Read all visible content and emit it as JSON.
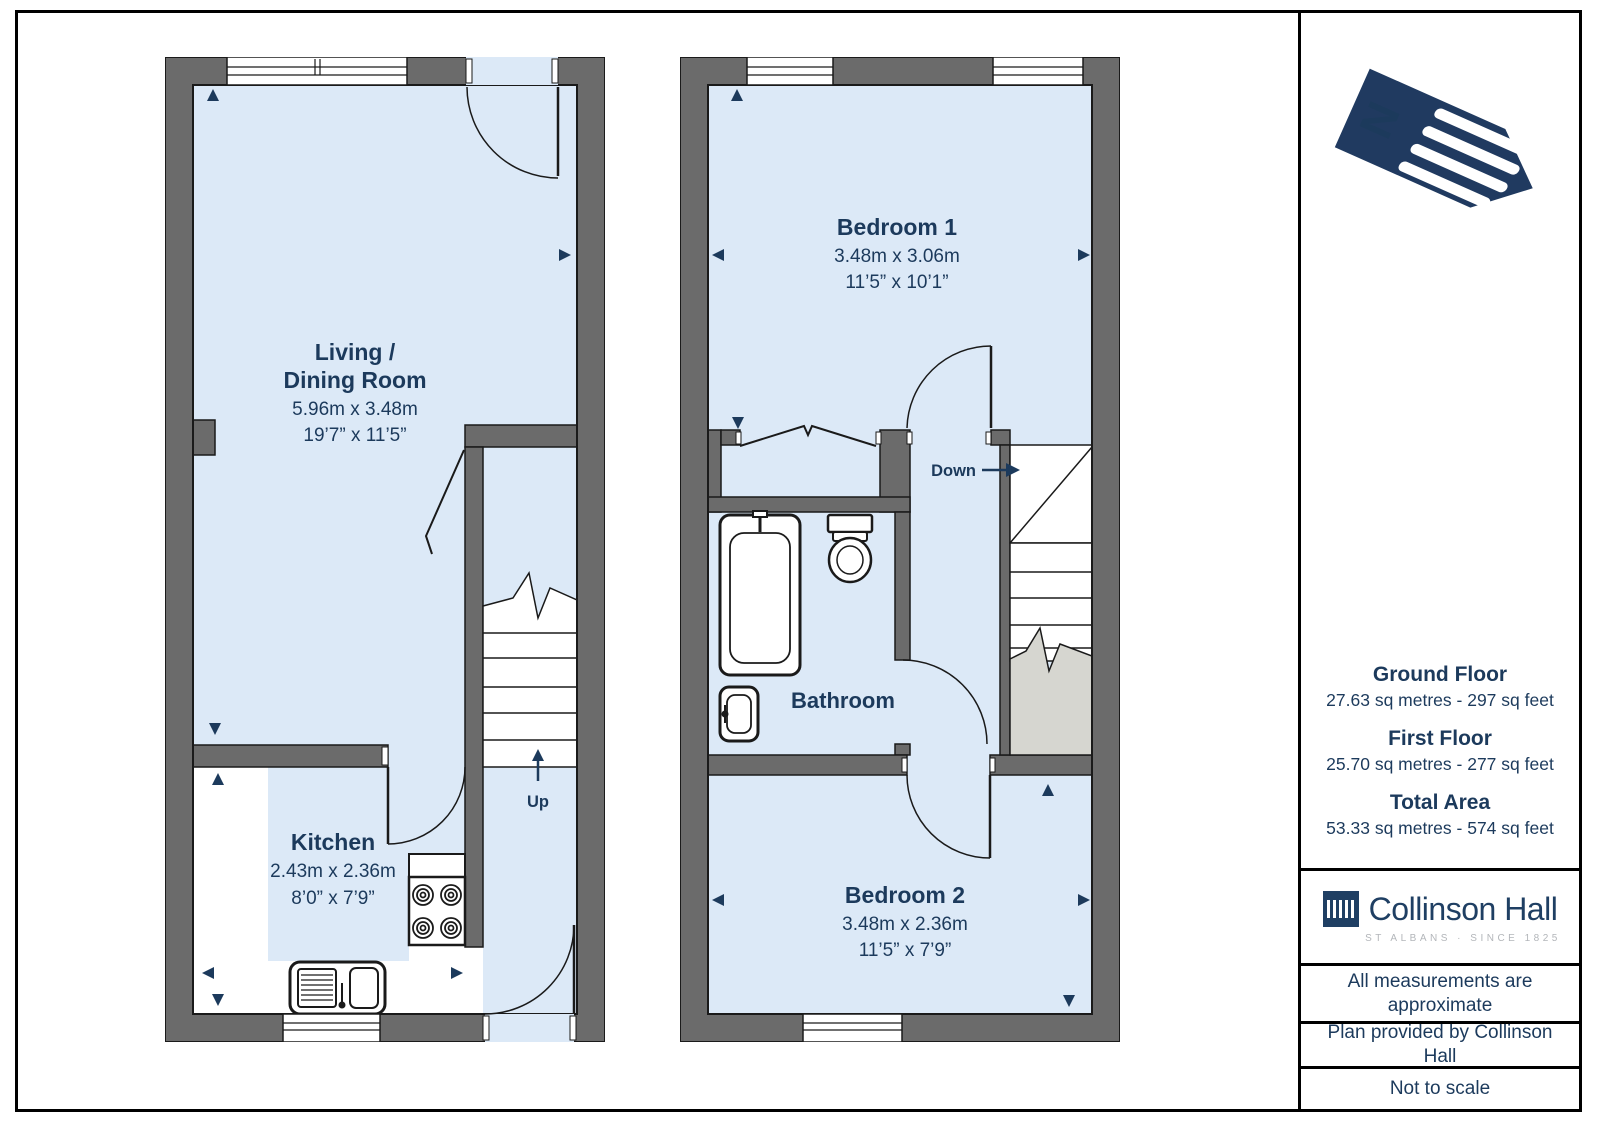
{
  "colors": {
    "wall": "#6b6b6b",
    "room_fill": "#dce9f7",
    "outline": "#1a1a1a",
    "navy_text": "#1c3a5c",
    "stair_void": "#d6d6d0",
    "brand_navy": "#1f3f63",
    "brand_gray": "#b3b6ba"
  },
  "compass": {
    "letter": "N"
  },
  "floors": {
    "ground": {
      "living": {
        "line1": "Living /",
        "line2": "Dining Room",
        "metric": "5.96m x 3.48m",
        "imperial": "19’7” x 11’5”"
      },
      "kitchen": {
        "name": "Kitchen",
        "metric": "2.43m x 2.36m",
        "imperial": "8’0” x 7’9”"
      },
      "stairs_label": "Up"
    },
    "first": {
      "bedroom1": {
        "name": "Bedroom 1",
        "metric": "3.48m x 3.06m",
        "imperial": "11’5” x 10’1”"
      },
      "bathroom": {
        "name": "Bathroom"
      },
      "bedroom2": {
        "name": "Bedroom 2",
        "metric": "3.48m x 2.36m",
        "imperial": "11’5” x 7’9”"
      },
      "stairs_label": "Down"
    }
  },
  "sidebar": {
    "areas": [
      {
        "title": "Ground Floor",
        "detail": "27.63 sq metres - 297 sq feet"
      },
      {
        "title": "First Floor",
        "detail": "25.70 sq metres - 277 sq feet"
      },
      {
        "title": "Total Area",
        "detail": "53.33 sq metres - 574 sq feet"
      }
    ],
    "brand": {
      "name": "Collinson Hall",
      "tagline": "ST ALBANS · SINCE 1825"
    },
    "notes": [
      "All measurements are approximate",
      "Plan provided by Collinson Hall",
      "Not to scale"
    ]
  }
}
